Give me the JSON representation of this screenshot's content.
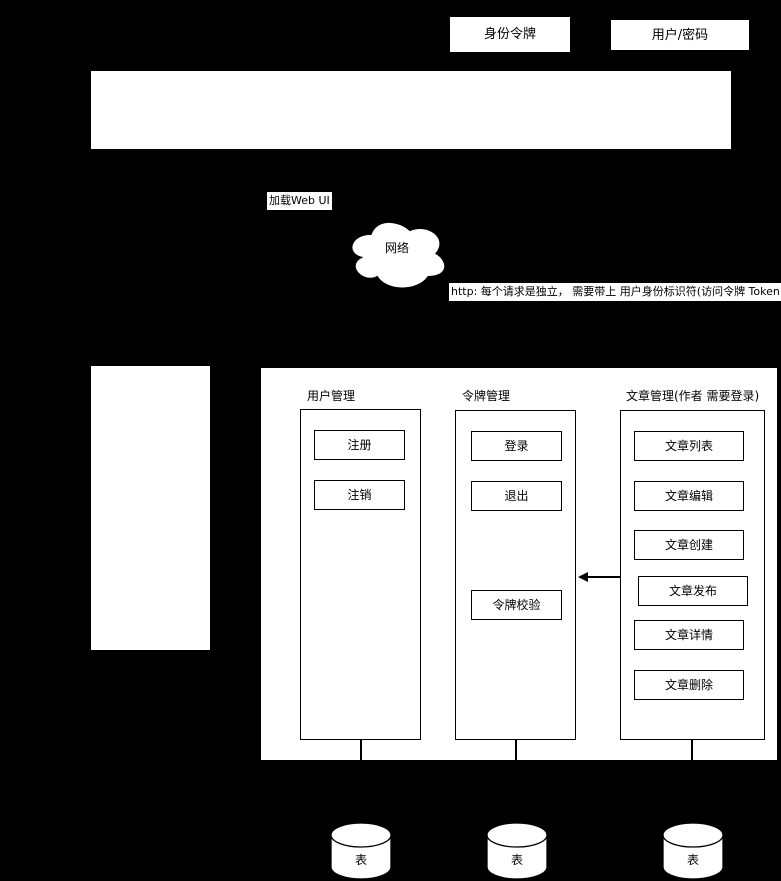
{
  "colors": {
    "background": "#000000",
    "surface": "#ffffff",
    "line": "#000000"
  },
  "top_labels": {
    "token": "身份令牌",
    "credentials": "用户/密码"
  },
  "network": {
    "load_label": "加载Web UI",
    "cloud_label": "网络",
    "http_note": "http: 每个请求是独立， 需要带上 用户身份标识符(访问令牌 Token)"
  },
  "backend": {
    "modules": [
      {
        "title": "用户管理",
        "items": [
          "注册",
          "注销"
        ]
      },
      {
        "title": "令牌管理",
        "items": [
          "登录",
          "退出",
          "令牌校验"
        ]
      },
      {
        "title": "文章管理(作者 需要登录)",
        "items": [
          "文章列表",
          "文章编辑",
          "文章创建",
          "文章发布",
          "文章详情",
          "文章删除"
        ]
      }
    ]
  },
  "databases": [
    {
      "label": "表"
    },
    {
      "label": "表"
    },
    {
      "label": "表"
    }
  ]
}
